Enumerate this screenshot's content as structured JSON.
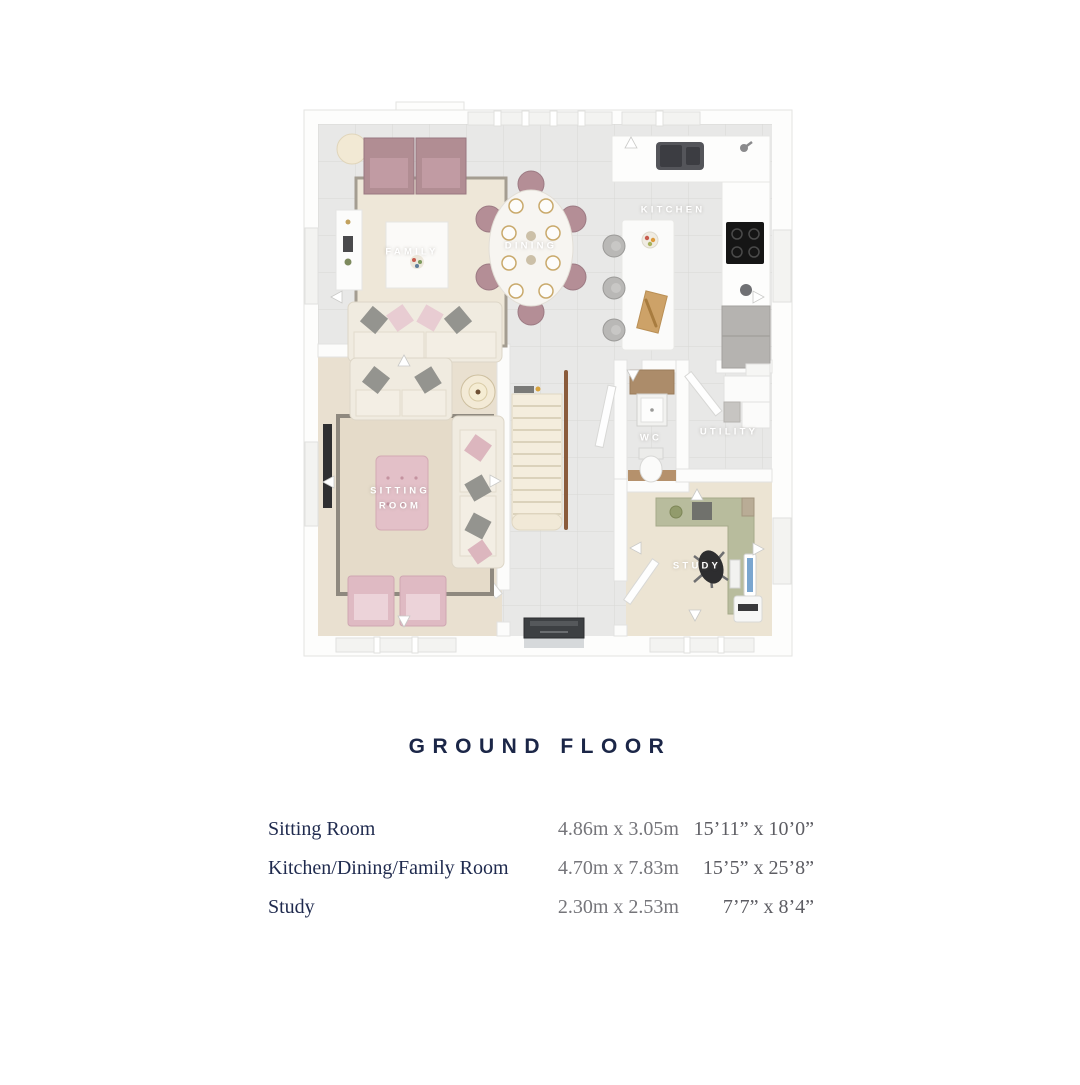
{
  "page": {
    "title": "GROUND FLOOR"
  },
  "plan": {
    "room_labels": {
      "family": "FAMILY",
      "dining": "DINING",
      "kitchen": "KITCHEN",
      "sitting_room": "SITTING ROOM",
      "wc": "WC",
      "utility": "UTILITY",
      "study": "STUDY"
    }
  },
  "dimensions_table": {
    "rows": [
      {
        "room": "Sitting Room",
        "metric": "4.86m x 3.05m",
        "imperial": "15’11” x 10’0”"
      },
      {
        "room": "Kitchen/Dining/Family Room",
        "metric": "4.70m x 7.83m",
        "imperial": "15’5” x 25’8”"
      },
      {
        "room": "Study",
        "metric": "2.30m x 2.53m",
        "imperial": "7’7” x 8’4”"
      }
    ]
  },
  "colors": {
    "title_navy": "#1b2647",
    "dimension_gray": "#75757a",
    "wall_white": "#ffffff",
    "tile_gray": "#e8e8e7",
    "carpet_beige": "#e9e0d0",
    "accent_mauve": "#b18d93",
    "accent_pink": "#e1bdc5",
    "accent_sage": "#b8bc9d"
  }
}
